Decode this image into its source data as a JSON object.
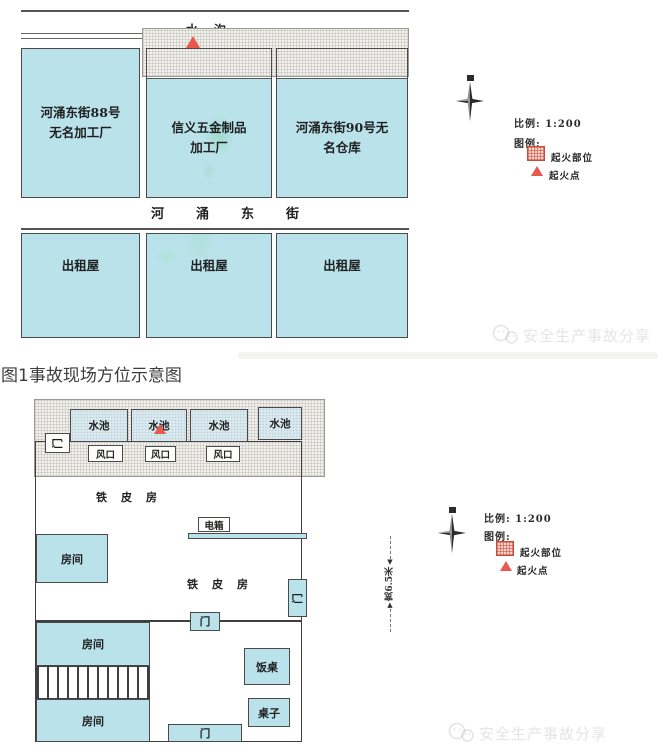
{
  "page": {
    "caption": "图1事故现场方位示意图",
    "watermark_text": "安全生产事故分享"
  },
  "colors": {
    "building_fill": "#b9e2ea",
    "pool_fill": "#d9e9ef",
    "hatch_fill": "#f1f0ec",
    "fire_red": "#e8584c",
    "line_dark": "#4a4a4a"
  },
  "map1": {
    "ditch_label": "水沟",
    "buildings": [
      {
        "name": "河涌东街88号\n无名加工厂"
      },
      {
        "name": "信义五金制品\n加工厂"
      },
      {
        "name": "河涌东街90号无\n名仓库"
      }
    ],
    "street_name": "河涌东街",
    "rental_houses": [
      "出租屋",
      "出租屋",
      "出租屋"
    ],
    "scale_label": "比例: 1:200",
    "legend_title": "图例:",
    "legend_fire_area": "起火部位",
    "legend_fire_point": "起火点"
  },
  "map2": {
    "pool_labels": [
      "水池",
      "水池",
      "水池",
      "水池"
    ],
    "vent_labels": [
      "风口",
      "风口",
      "风口"
    ],
    "door_labels": [
      "门",
      "门",
      "门",
      "门"
    ],
    "iron_house_label_1": "铁皮房",
    "iron_house_label_2": "铁皮房",
    "electric_box_label": "电箱",
    "room_labels": [
      "房间",
      "房间",
      "房间"
    ],
    "dining_table_label": "饭桌",
    "table_label": "桌子",
    "dimension_label": "宽6.5米",
    "scale_label": "比例: 1:200",
    "legend_title": "图例:",
    "legend_fire_area": "起火部位",
    "legend_fire_point": "起火点"
  }
}
